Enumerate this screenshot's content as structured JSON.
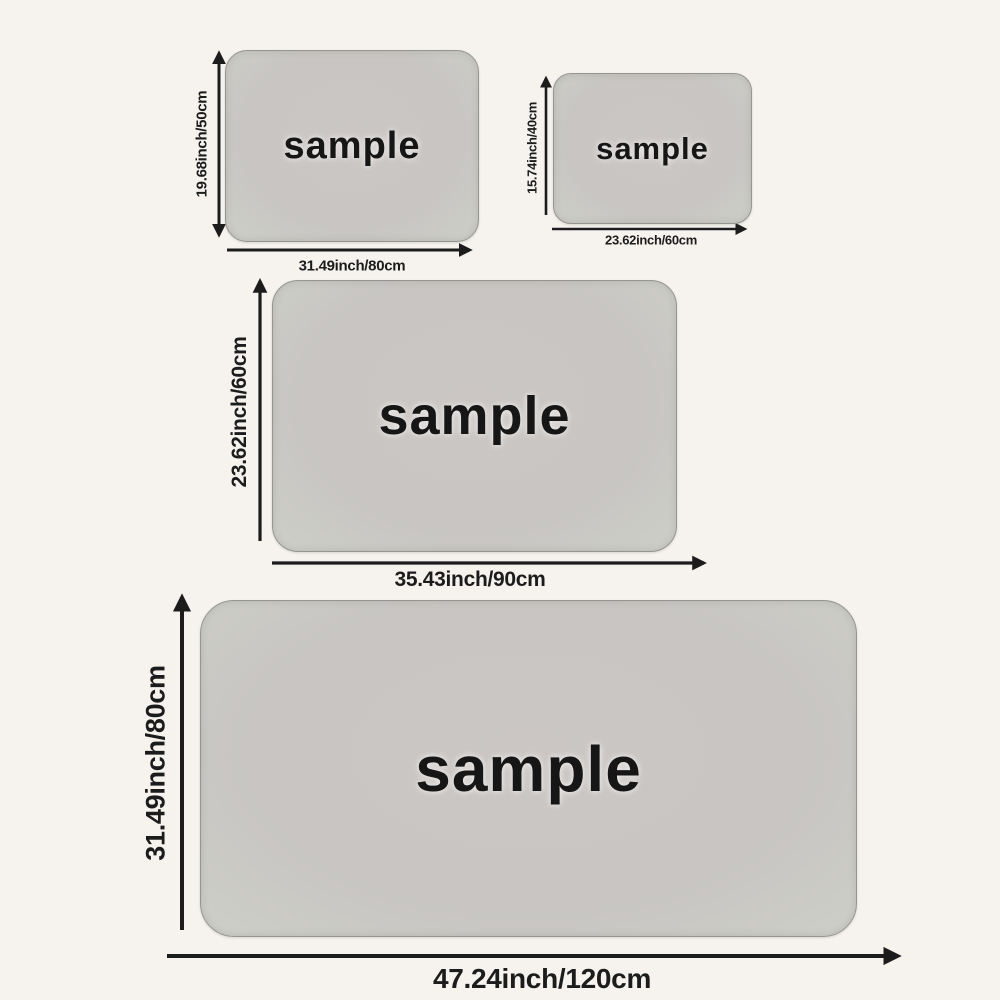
{
  "colors": {
    "background": "#f6f3ee",
    "mat_fill": "#c9c5c3",
    "mat_fill_edge": "#cdcfc8",
    "mat_border": "#97958f",
    "ink": "#1c1c1c"
  },
  "mats": [
    {
      "sample_label": "sample",
      "height_label": "19.68inch/50cm",
      "width_label": "31.49inch/80cm"
    },
    {
      "sample_label": "sample",
      "height_label": "15.74inch/40cm",
      "width_label": "23.62inch/60cm"
    },
    {
      "sample_label": "sample",
      "height_label": "23.62inch/60cm",
      "width_label": "35.43inch/90cm"
    },
    {
      "sample_label": "sample",
      "height_label": "31.49inch/80cm",
      "width_label": "47.24inch/120cm"
    }
  ]
}
